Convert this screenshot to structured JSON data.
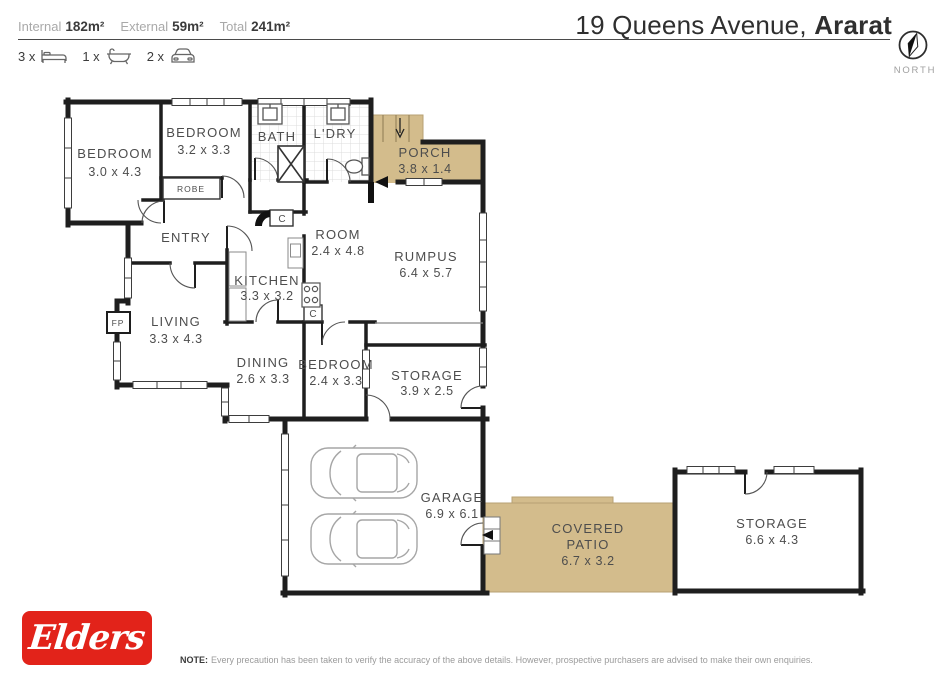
{
  "header": {
    "stats": [
      {
        "label": "Internal",
        "value": "182m²"
      },
      {
        "label": "External",
        "value": "59m²"
      },
      {
        "label": "Total",
        "value": "241m²"
      }
    ],
    "features": [
      {
        "count": "3 x",
        "icon": "bed-icon"
      },
      {
        "count": "1 x",
        "icon": "bath-icon"
      },
      {
        "count": "2 x",
        "icon": "car-icon"
      }
    ],
    "address_light": "19 Queens Avenue,",
    "address_bold": "Ararat",
    "compass_label": "NORTH"
  },
  "floorplan": {
    "rooms": [
      {
        "id": "bedroom-1",
        "name": "BEDROOM",
        "dims": "3.0 x 4.3"
      },
      {
        "id": "bedroom-2",
        "name": "BEDROOM",
        "dims": "3.2 x 3.3"
      },
      {
        "id": "bath",
        "name": "BATH"
      },
      {
        "id": "laundry",
        "name": "L'DRY"
      },
      {
        "id": "porch",
        "name": "PORCH",
        "dims": "3.8 x 1.4"
      },
      {
        "id": "entry",
        "name": "ENTRY"
      },
      {
        "id": "room",
        "name": "ROOM",
        "dims": "2.4 x 4.8"
      },
      {
        "id": "rumpus",
        "name": "RUMPUS",
        "dims": "6.4 x 5.7"
      },
      {
        "id": "kitchen",
        "name": "KITCHEN",
        "dims": "3.3 x 3.2"
      },
      {
        "id": "living",
        "name": "LIVING",
        "dims": "3.3 x 4.3"
      },
      {
        "id": "dining",
        "name": "DINING",
        "dims": "2.6 x 3.3"
      },
      {
        "id": "bedroom-3",
        "name": "BEDROOM",
        "dims": "2.4 x 3.3"
      },
      {
        "id": "storage-1",
        "name": "STORAGE",
        "dims": "3.9 x 2.5"
      },
      {
        "id": "garage",
        "name": "GARAGE",
        "dims": "6.9 x 6.1"
      },
      {
        "id": "covered-patio",
        "name": "COVERED",
        "name2": "PATIO",
        "dims": "6.7 x 3.2"
      },
      {
        "id": "storage-2",
        "name": "STORAGE",
        "dims": "6.6 x 4.3"
      }
    ],
    "markers": {
      "robe": "ROBE",
      "cupboard": "C",
      "fireplace": "FP"
    },
    "colors": {
      "wall": "#1e1e1e",
      "outdoor_fill": "#d3bc8c",
      "tile_line": "#dcdcdc"
    }
  },
  "footer": {
    "brand": "Elders",
    "brand_color": "#e2231a",
    "note_label": "NOTE:",
    "note_text": "Every precaution has been taken to verify the accuracy of the above details. However, prospective purchasers are advised to make their own enquiries."
  }
}
